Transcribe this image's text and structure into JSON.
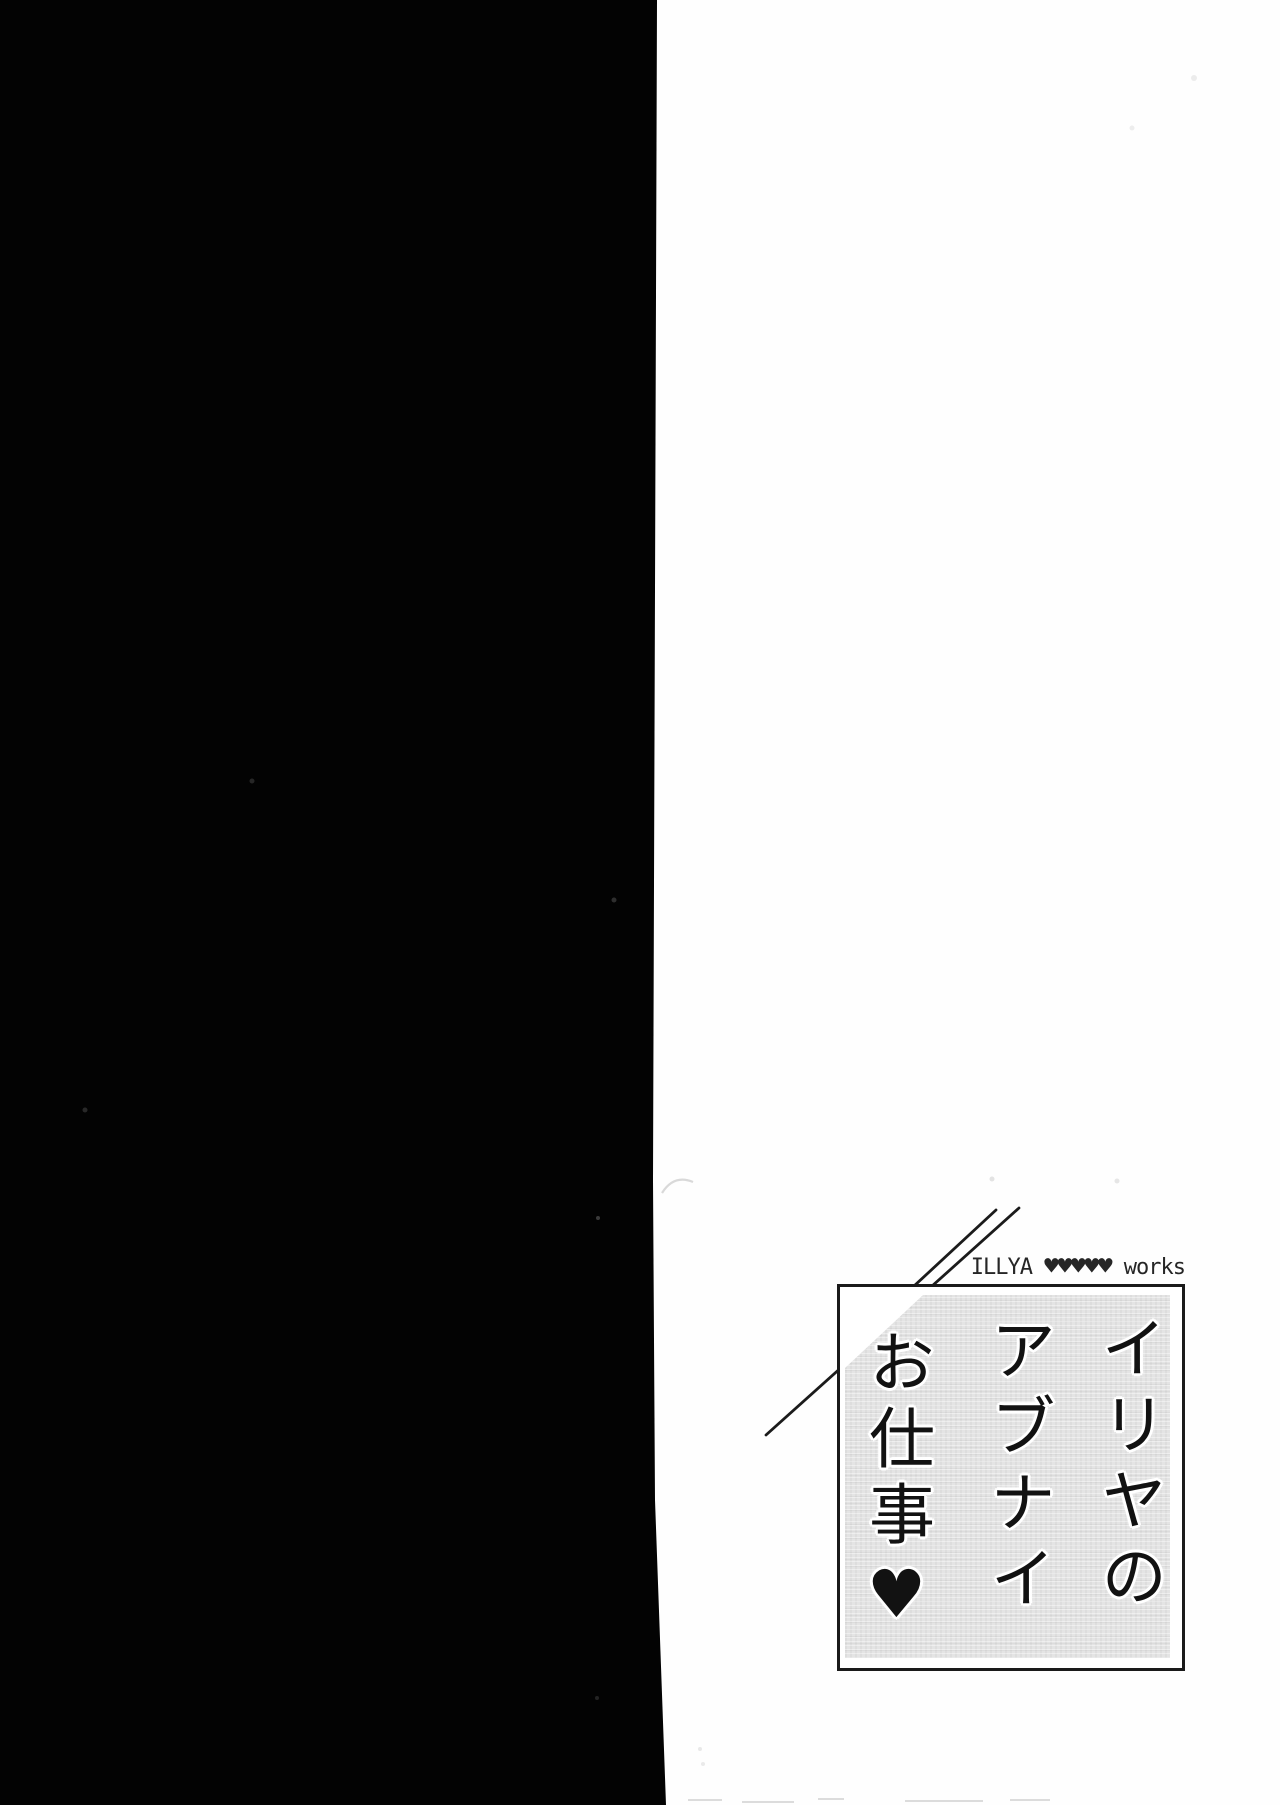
{
  "page": {
    "colors": {
      "black_page": "#030303",
      "paper": "#fefefe",
      "plate_panel": "#e4e4e4",
      "ink": "#1a1a1a"
    }
  },
  "plate": {
    "credit": {
      "artist": "ILLYA ",
      "hearts": "♥♥♥♥♥",
      "suffix": " works"
    },
    "title_full": "イリヤのアブナイお仕事♥",
    "title_columns": [
      "イリヤの",
      "アブナイ",
      "お仕事♥"
    ]
  }
}
